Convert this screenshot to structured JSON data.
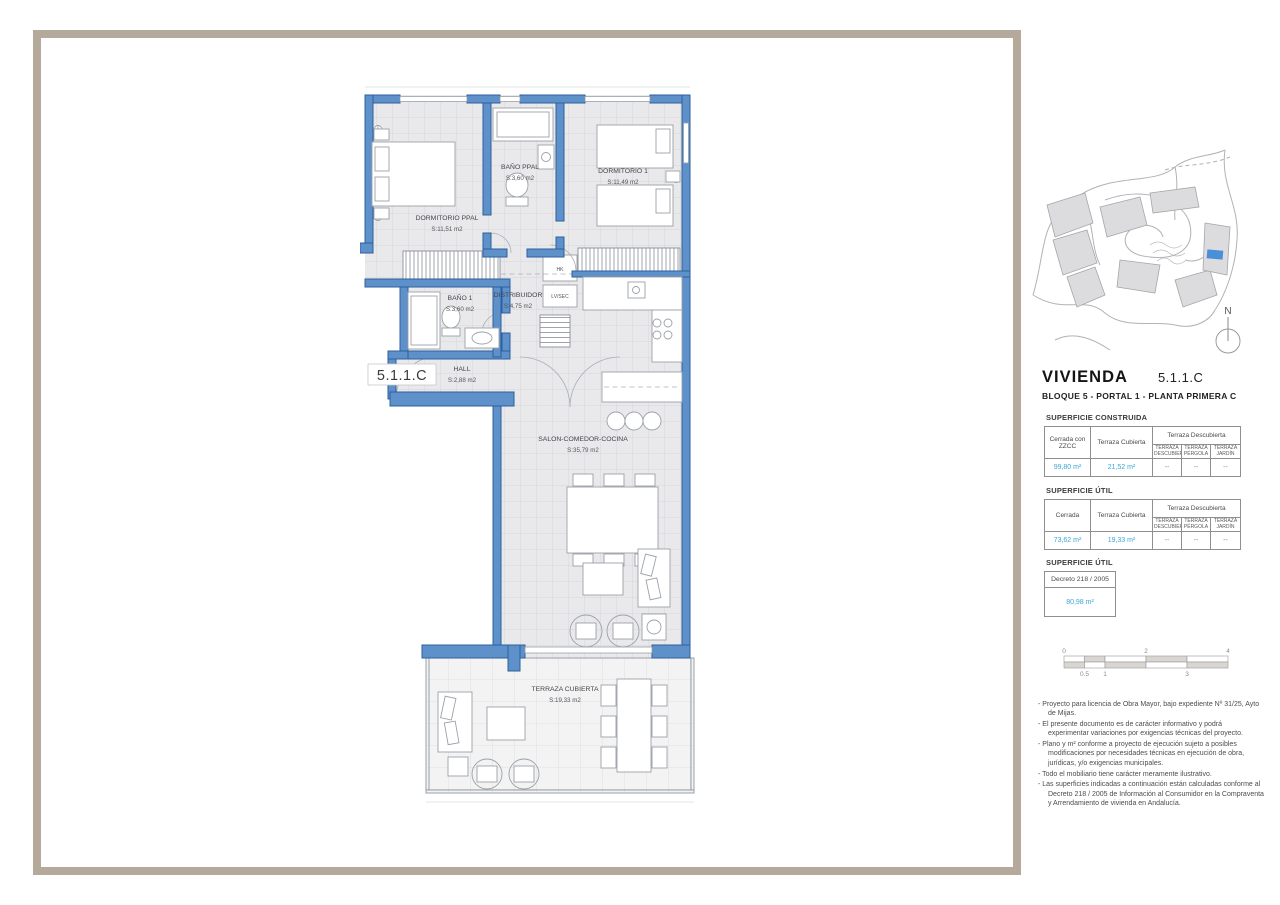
{
  "plan": {
    "unit_label": "5.1.1.C",
    "rooms": [
      {
        "name": "DORMITORIO PPAL",
        "area": "S:11,51 m2"
      },
      {
        "name": "BAÑO PPAL",
        "area": "S:3,60 m2"
      },
      {
        "name": "DORMITORIO 1",
        "area": "S:11,49 m2"
      },
      {
        "name": "BAÑO 1",
        "area": "S:3,60 m2"
      },
      {
        "name": "DISTRIBUIDOR",
        "area": "S:4,75 m2"
      },
      {
        "name": "HALL",
        "area": "S:2,88 m2"
      },
      {
        "name": "SALON-COMEDOR-COCINA",
        "area": "S:35,79 m2"
      },
      {
        "name": "TERRAZA CUBIERTA",
        "area": "S:19,33 m2"
      }
    ],
    "closets": [
      {
        "label": "HK"
      },
      {
        "label": "LV/SEC"
      }
    ]
  },
  "sidebar": {
    "north_label": "N",
    "title": "VIVIENDA",
    "unit": "5.1.1.C",
    "subtitle": "BLOQUE 5 - PORTAL 1 - PLANTA PRIMERA C",
    "construida": {
      "heading": "SUPERFICIE CONSTRUIDA",
      "cols": [
        "Cerrada con ZZCC",
        "Terraza Cubierta",
        "Terraza Descubierta"
      ],
      "subcols": [
        "TERRAZA DESCUBIERTA",
        "TERRAZA PÉRGOLA",
        "TERRAZA JARDÍN"
      ],
      "values": [
        "99,80 m²",
        "21,52 m²",
        "--",
        "--",
        "--"
      ]
    },
    "util": {
      "heading": "SUPERFICIE ÚTIL",
      "cols": [
        "Cerrada",
        "Terraza Cubierta",
        "Terraza Descubierta"
      ],
      "subcols": [
        "TERRAZA DESCUBIERTA",
        "TERRAZA PÉRGOLA",
        "TERRAZA JARDÍN"
      ],
      "values": [
        "73,62 m²",
        "19,33 m²",
        "--",
        "--",
        "--"
      ]
    },
    "util_decreto": {
      "heading": "SUPERFICIE ÚTIL",
      "header": "Decreto  218 / 2005",
      "value": "80,98 m²"
    },
    "scale": {
      "top": [
        "0",
        "2",
        "4"
      ],
      "bottom": [
        "0.5",
        "1",
        "3"
      ]
    },
    "notes": [
      "-  Proyecto para licencia de Obra Mayor, bajo expediente Nº 31/25, Ayto de Mijas.",
      "-  El presente documento es de carácter informativo y podrá experimentar variaciones por exigencias técnicas del proyecto.",
      "-  Plano y m² conforme a proyecto de ejecución sujeto a posibles modificaciones por necesidades técnicas en ejecución de obra, jurídicas, y/o exigencias municipales.",
      "-  Todo el mobiliario tiene carácter meramente ilustrativo.",
      "-  Las superficies indicadas a continuación están calculadas conforme al Decreto 218 / 2005  de Información al Consumidor en la Compraventa y Arrendamiento de vivienda en Andalucía."
    ]
  },
  "colors": {
    "accent": "#3aa5d8",
    "wall_fill": "#5e90ca",
    "wall_stroke": "#2d5f9e",
    "frame": "#b5a99c",
    "map_highlight": "#4a90d9"
  }
}
